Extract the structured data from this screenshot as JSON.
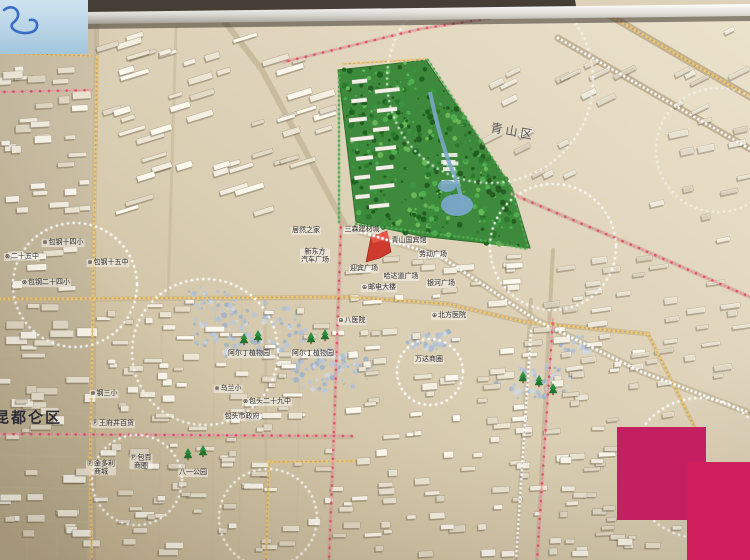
{
  "description": "Photograph of a physical 3D city-planning scale model (Baotou) with beige base, white building blocks, a green park, LED-bead street lights (gold, white, pink) and dotted business-circle rings; magenta patches cover the lower-right corner.",
  "labels": [
    {
      "text": "青山区",
      "x": 513,
      "y": 131,
      "type": "district",
      "icon": null
    },
    {
      "text": "昆都仑区",
      "x": 0,
      "y": 417,
      "type": "district",
      "icon": null
    },
    {
      "text": "居然之家",
      "x": 306,
      "y": 231,
      "type": "poi",
      "icon": null
    },
    {
      "text": "三森建材城",
      "x": 362,
      "y": 230,
      "type": "poi",
      "icon": null
    },
    {
      "lines": [
        "新东方",
        "汽车广场"
      ],
      "x": 315,
      "y": 256,
      "type": "poi",
      "icon": null
    },
    {
      "text": "青山国宾馆",
      "x": 409,
      "y": 241,
      "type": "poi",
      "icon": null
    },
    {
      "text": "劳动广场",
      "x": 433,
      "y": 255,
      "type": "poi",
      "icon": null
    },
    {
      "text": "迎宾广场",
      "x": 364,
      "y": 269,
      "type": "poi",
      "icon": null
    },
    {
      "text": "哈达道广场",
      "x": 401,
      "y": 277,
      "type": "poi",
      "icon": null
    },
    {
      "text": "邮电大楼",
      "x": 379,
      "y": 288,
      "type": "poi",
      "icon": "poi-icon"
    },
    {
      "text": "银河广场",
      "x": 441,
      "y": 284,
      "type": "poi",
      "icon": null
    },
    {
      "text": "北方医院",
      "x": 449,
      "y": 316,
      "type": "poi",
      "icon": "hospital-icon"
    },
    {
      "text": "八医院",
      "x": 352,
      "y": 321,
      "type": "poi",
      "icon": "hospital-icon"
    },
    {
      "text": "万达商圈",
      "x": 429,
      "y": 360,
      "type": "poi",
      "icon": null
    },
    {
      "text": "阿尔丁植物园",
      "x": 249,
      "y": 354,
      "type": "poi",
      "icon": null
    },
    {
      "text": "阿尔丁植物园",
      "x": 313,
      "y": 354,
      "type": "poi",
      "icon": null
    },
    {
      "text": "乌兰小",
      "x": 228,
      "y": 389,
      "type": "poi",
      "icon": "school-icon"
    },
    {
      "text": "包头二十九中",
      "x": 267,
      "y": 402,
      "type": "poi",
      "icon": "school-icon"
    },
    {
      "text": "包头市政府",
      "x": 242,
      "y": 417,
      "type": "poi",
      "icon": null
    },
    {
      "text": "王府井百货",
      "x": 113,
      "y": 424,
      "type": "poi",
      "icon": "parking-icon"
    },
    {
      "lines": [
        "金多利",
        "商城"
      ],
      "x": 101,
      "y": 468,
      "type": "poi",
      "icon": "parking-icon"
    },
    {
      "lines": [
        "包百",
        "商圈"
      ],
      "x": 141,
      "y": 462,
      "type": "poi",
      "icon": "parking-icon"
    },
    {
      "text": "八一公园",
      "x": 193,
      "y": 473,
      "type": "poi",
      "icon": null
    },
    {
      "text": "包钢十四小",
      "x": 63,
      "y": 243,
      "type": "poi",
      "icon": "school-icon"
    },
    {
      "text": "二十五中",
      "x": 22,
      "y": 257,
      "type": "poi",
      "icon": "school-icon"
    },
    {
      "text": "包钢二十四小",
      "x": 46,
      "y": 283,
      "type": "poi",
      "icon": "school-icon"
    },
    {
      "text": "包钢十五中",
      "x": 108,
      "y": 263,
      "type": "poi",
      "icon": "school-icon"
    },
    {
      "text": "钢三小",
      "x": 104,
      "y": 394,
      "type": "poi",
      "icon": "school-icon"
    }
  ],
  "icon_glyphs": {
    "school-icon": "⊗",
    "hospital-icon": "⊕",
    "parking-icon": "Ⓟ",
    "poi-icon": "⊕"
  },
  "colors": {
    "board_light": "#ece3cd",
    "board_mid": "#d9cdb2",
    "board_dark": "#c4b593",
    "park_green": "#3e8a3c",
    "led_gold": "#f3c76e",
    "led_white": "#ffffff",
    "led_pink": "#f2a3af",
    "led_red": "#dd5864",
    "led_green": "#46b24c",
    "patch_magenta_1": "#c42061",
    "patch_magenta_2": "#d01d5b",
    "wall_dark": "#453e36",
    "sky_corner": "#bcd8ea",
    "river_blue": "#7ba7c9",
    "red_building": "#cf3a2e",
    "label_ink": "#2f2f38"
  }
}
